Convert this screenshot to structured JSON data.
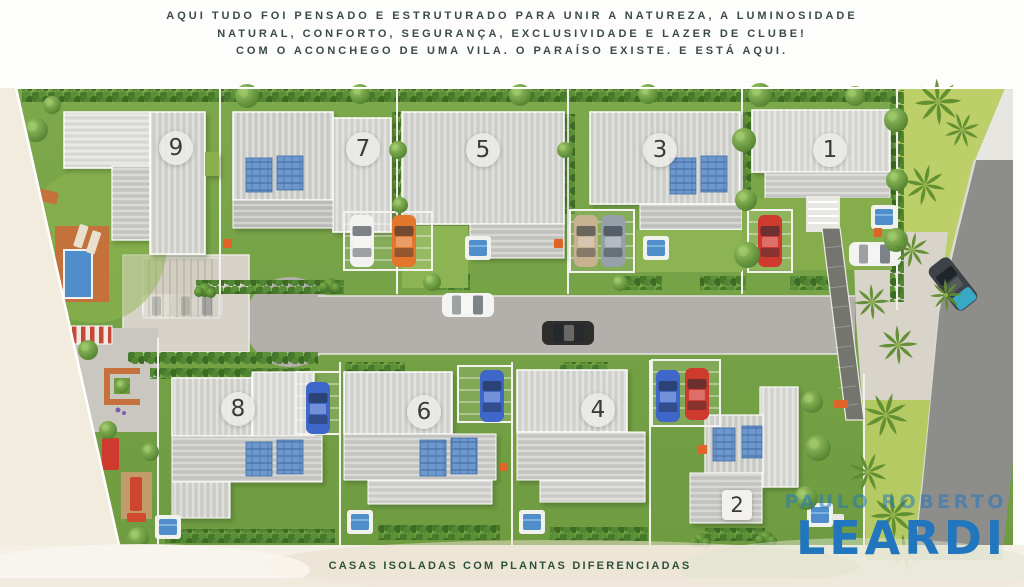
{
  "header": {
    "line1": "AQUI TUDO FOI PENSADO E ESTRUTURADO PARA UNIR A NATUREZA, A LUMINOSIDADE",
    "line2": "NATURAL, CONFORTO, SEGURANÇA, EXCLUSIVIDADE E LAZER DE CLUBE!",
    "line3": "COM O ACONCHEGO DE UMA VILA. O PARAÍSO EXISTE. E ESTÁ AQUI."
  },
  "site_plan": {
    "houses": [
      {
        "number": "9"
      },
      {
        "number": "7"
      },
      {
        "number": "5"
      },
      {
        "number": "3"
      },
      {
        "number": "1"
      },
      {
        "number": "8"
      },
      {
        "number": "6"
      },
      {
        "number": "4"
      },
      {
        "number": "2"
      }
    ]
  },
  "caption": {
    "text": "CASAS ISOLADAS COM PLANTAS DIFERENCIADAS"
  },
  "logo": {
    "line1": "PAULO ROBERTO",
    "line2": "LEARDI"
  },
  "colors": {
    "logo_blue": "#2176bd",
    "header_text": "#3b4a4b",
    "caption_green": "#2d5137",
    "grass_green": "#79a348",
    "road_gray": "#b3b0ab",
    "street_gray": "#8d8d8a",
    "solar_panel_blue": "#6d98ce",
    "pool_blue": "#4f8ecb",
    "deck_orange": "#c4713b"
  }
}
